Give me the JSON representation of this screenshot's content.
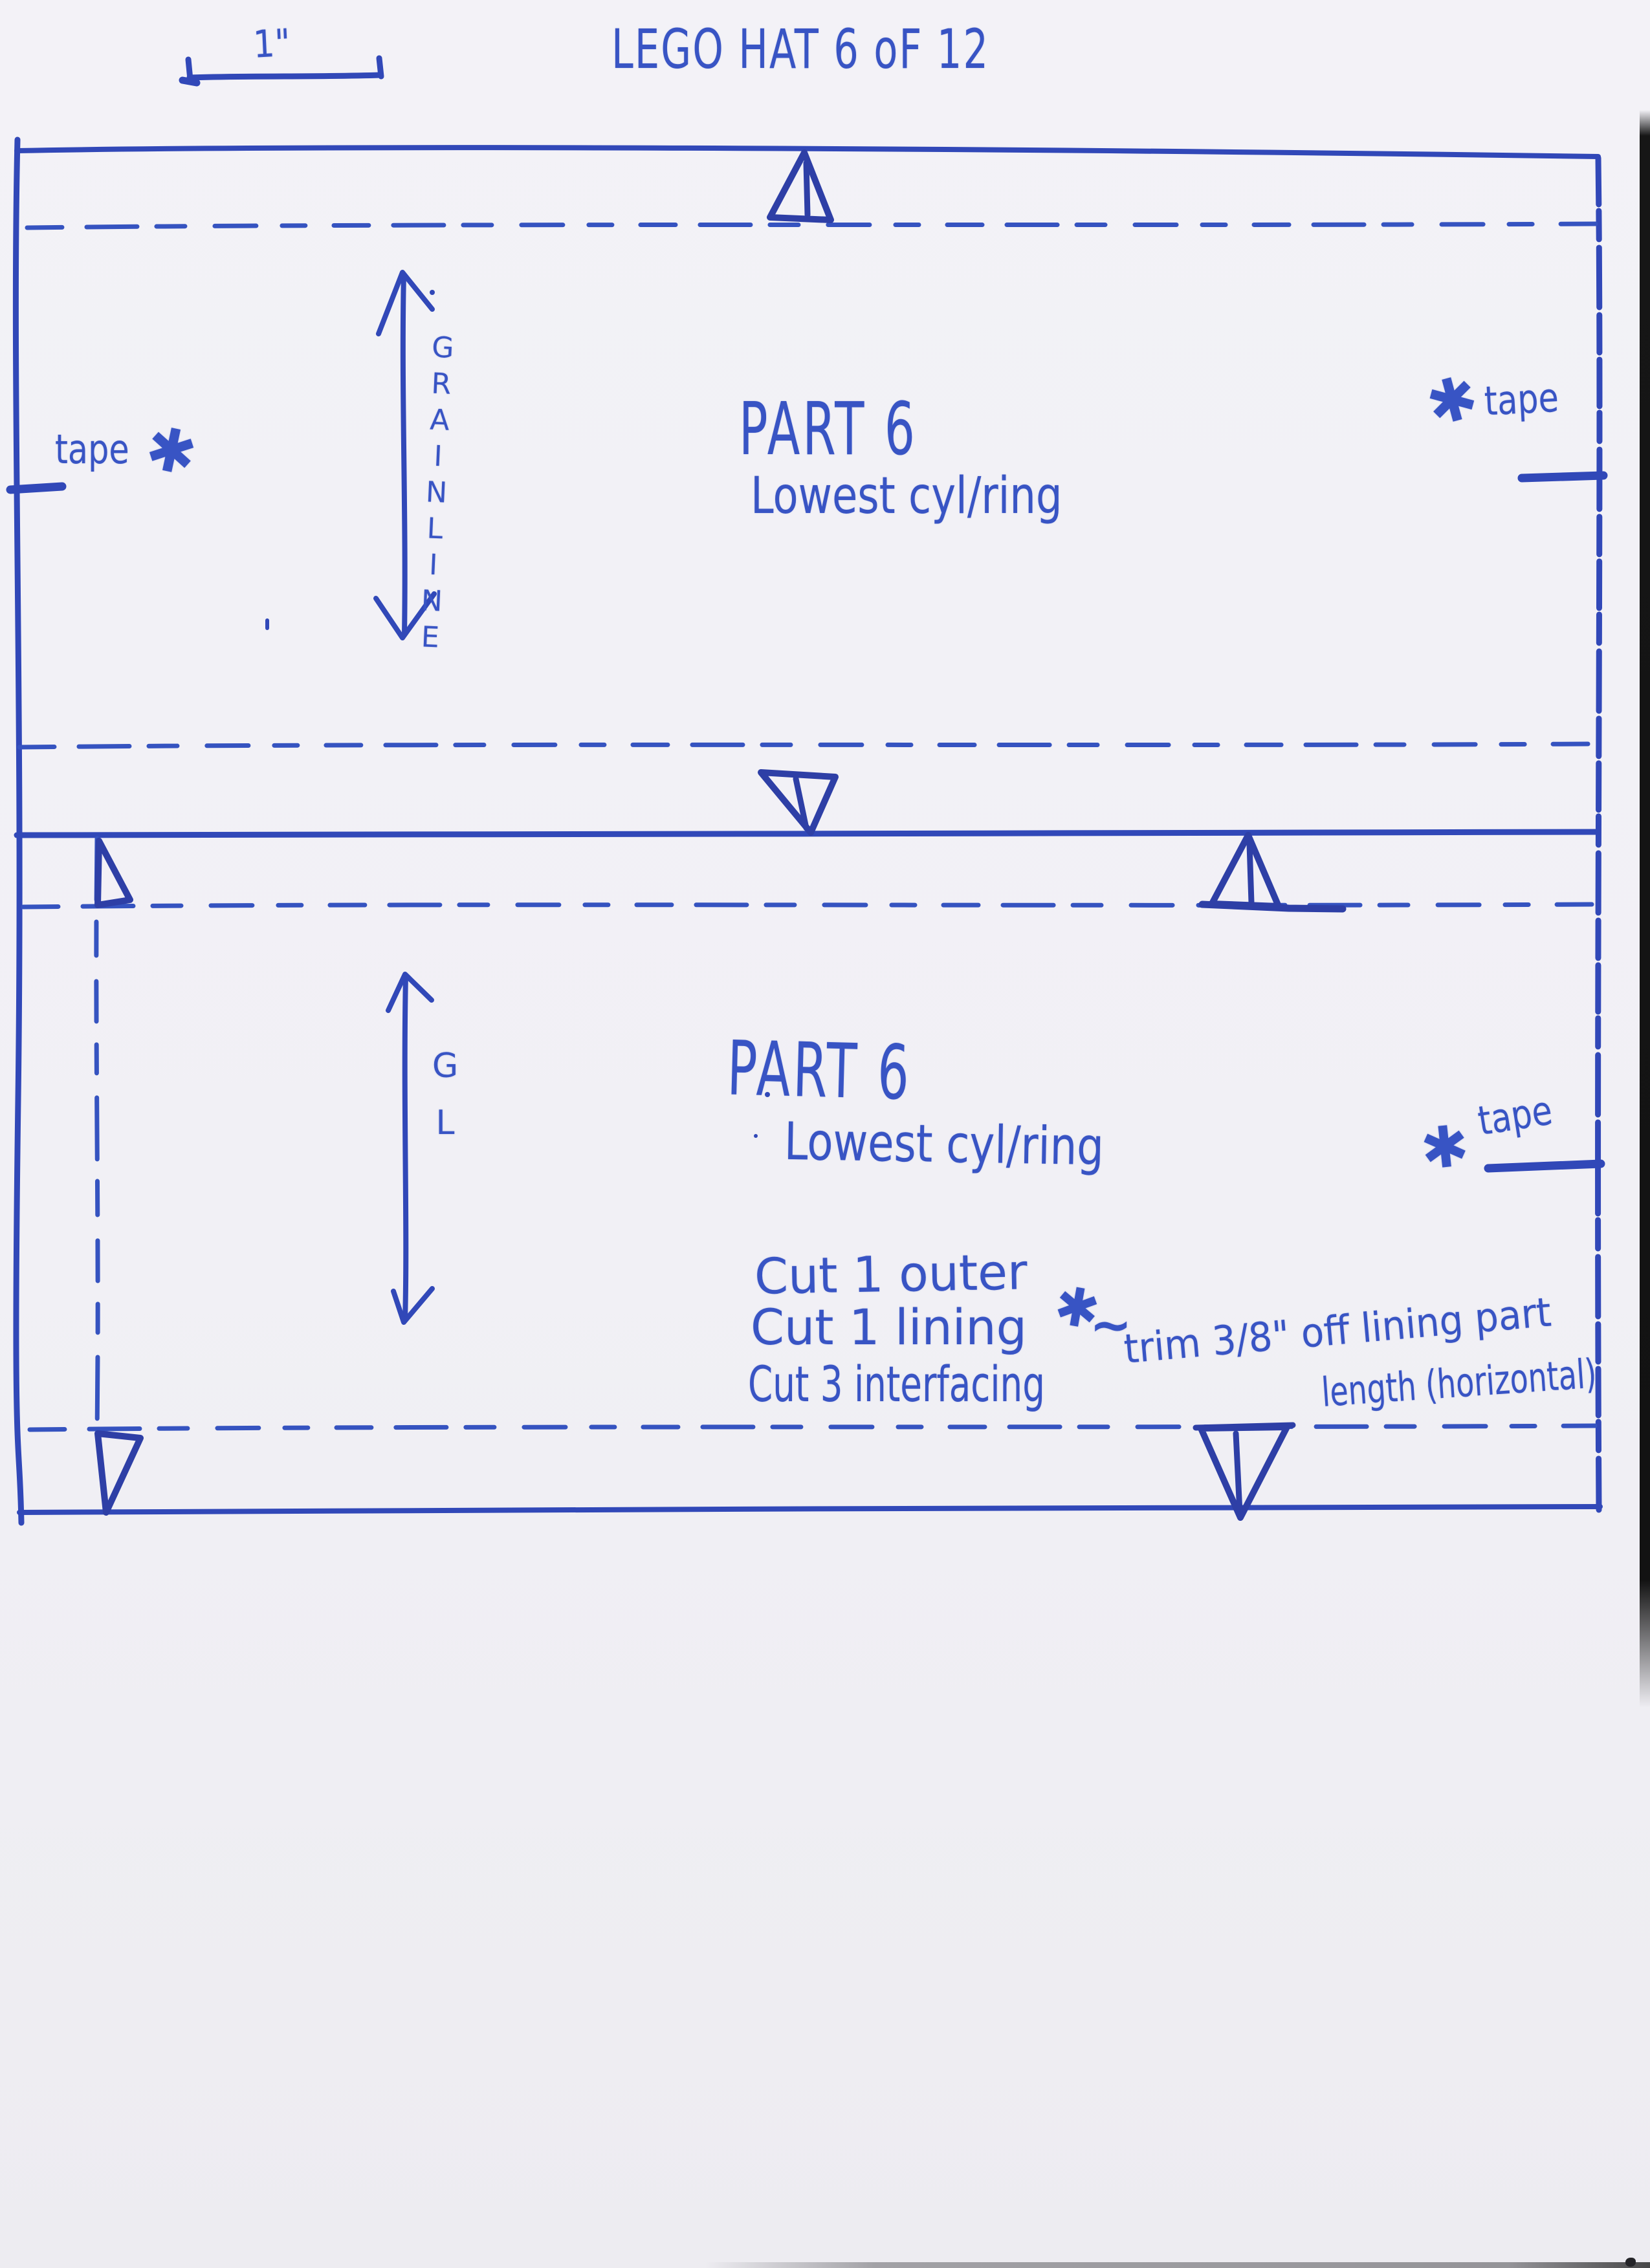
{
  "pen_color": "#3854c4",
  "paper_color": "#f1f0f5",
  "page_title": "LEGO HAT 6 oF 12",
  "scale_bar": {
    "label": "1\""
  },
  "symbols": {
    "tape_star": "✱",
    "tilde": "~"
  },
  "upper_piece": {
    "grainline_label": "GRAINLINE",
    "part_label": "PART 6",
    "part_sublabel": "Lowest cyl/ring",
    "tape_left_label": "tape",
    "tape_right_label": "tape"
  },
  "lower_piece": {
    "grainline_label": "GL",
    "part_label": "PART 6",
    "part_sublabel": "Lowest cyl/ring",
    "tape_right_label": "tape",
    "cut_instructions": [
      "Cut 1 outer",
      "Cut 1 lining",
      "Cut 3 interfacing"
    ],
    "trim_note_line1": "trim 3/8\" off lining part",
    "trim_note_line2": "length (horizontal)"
  }
}
